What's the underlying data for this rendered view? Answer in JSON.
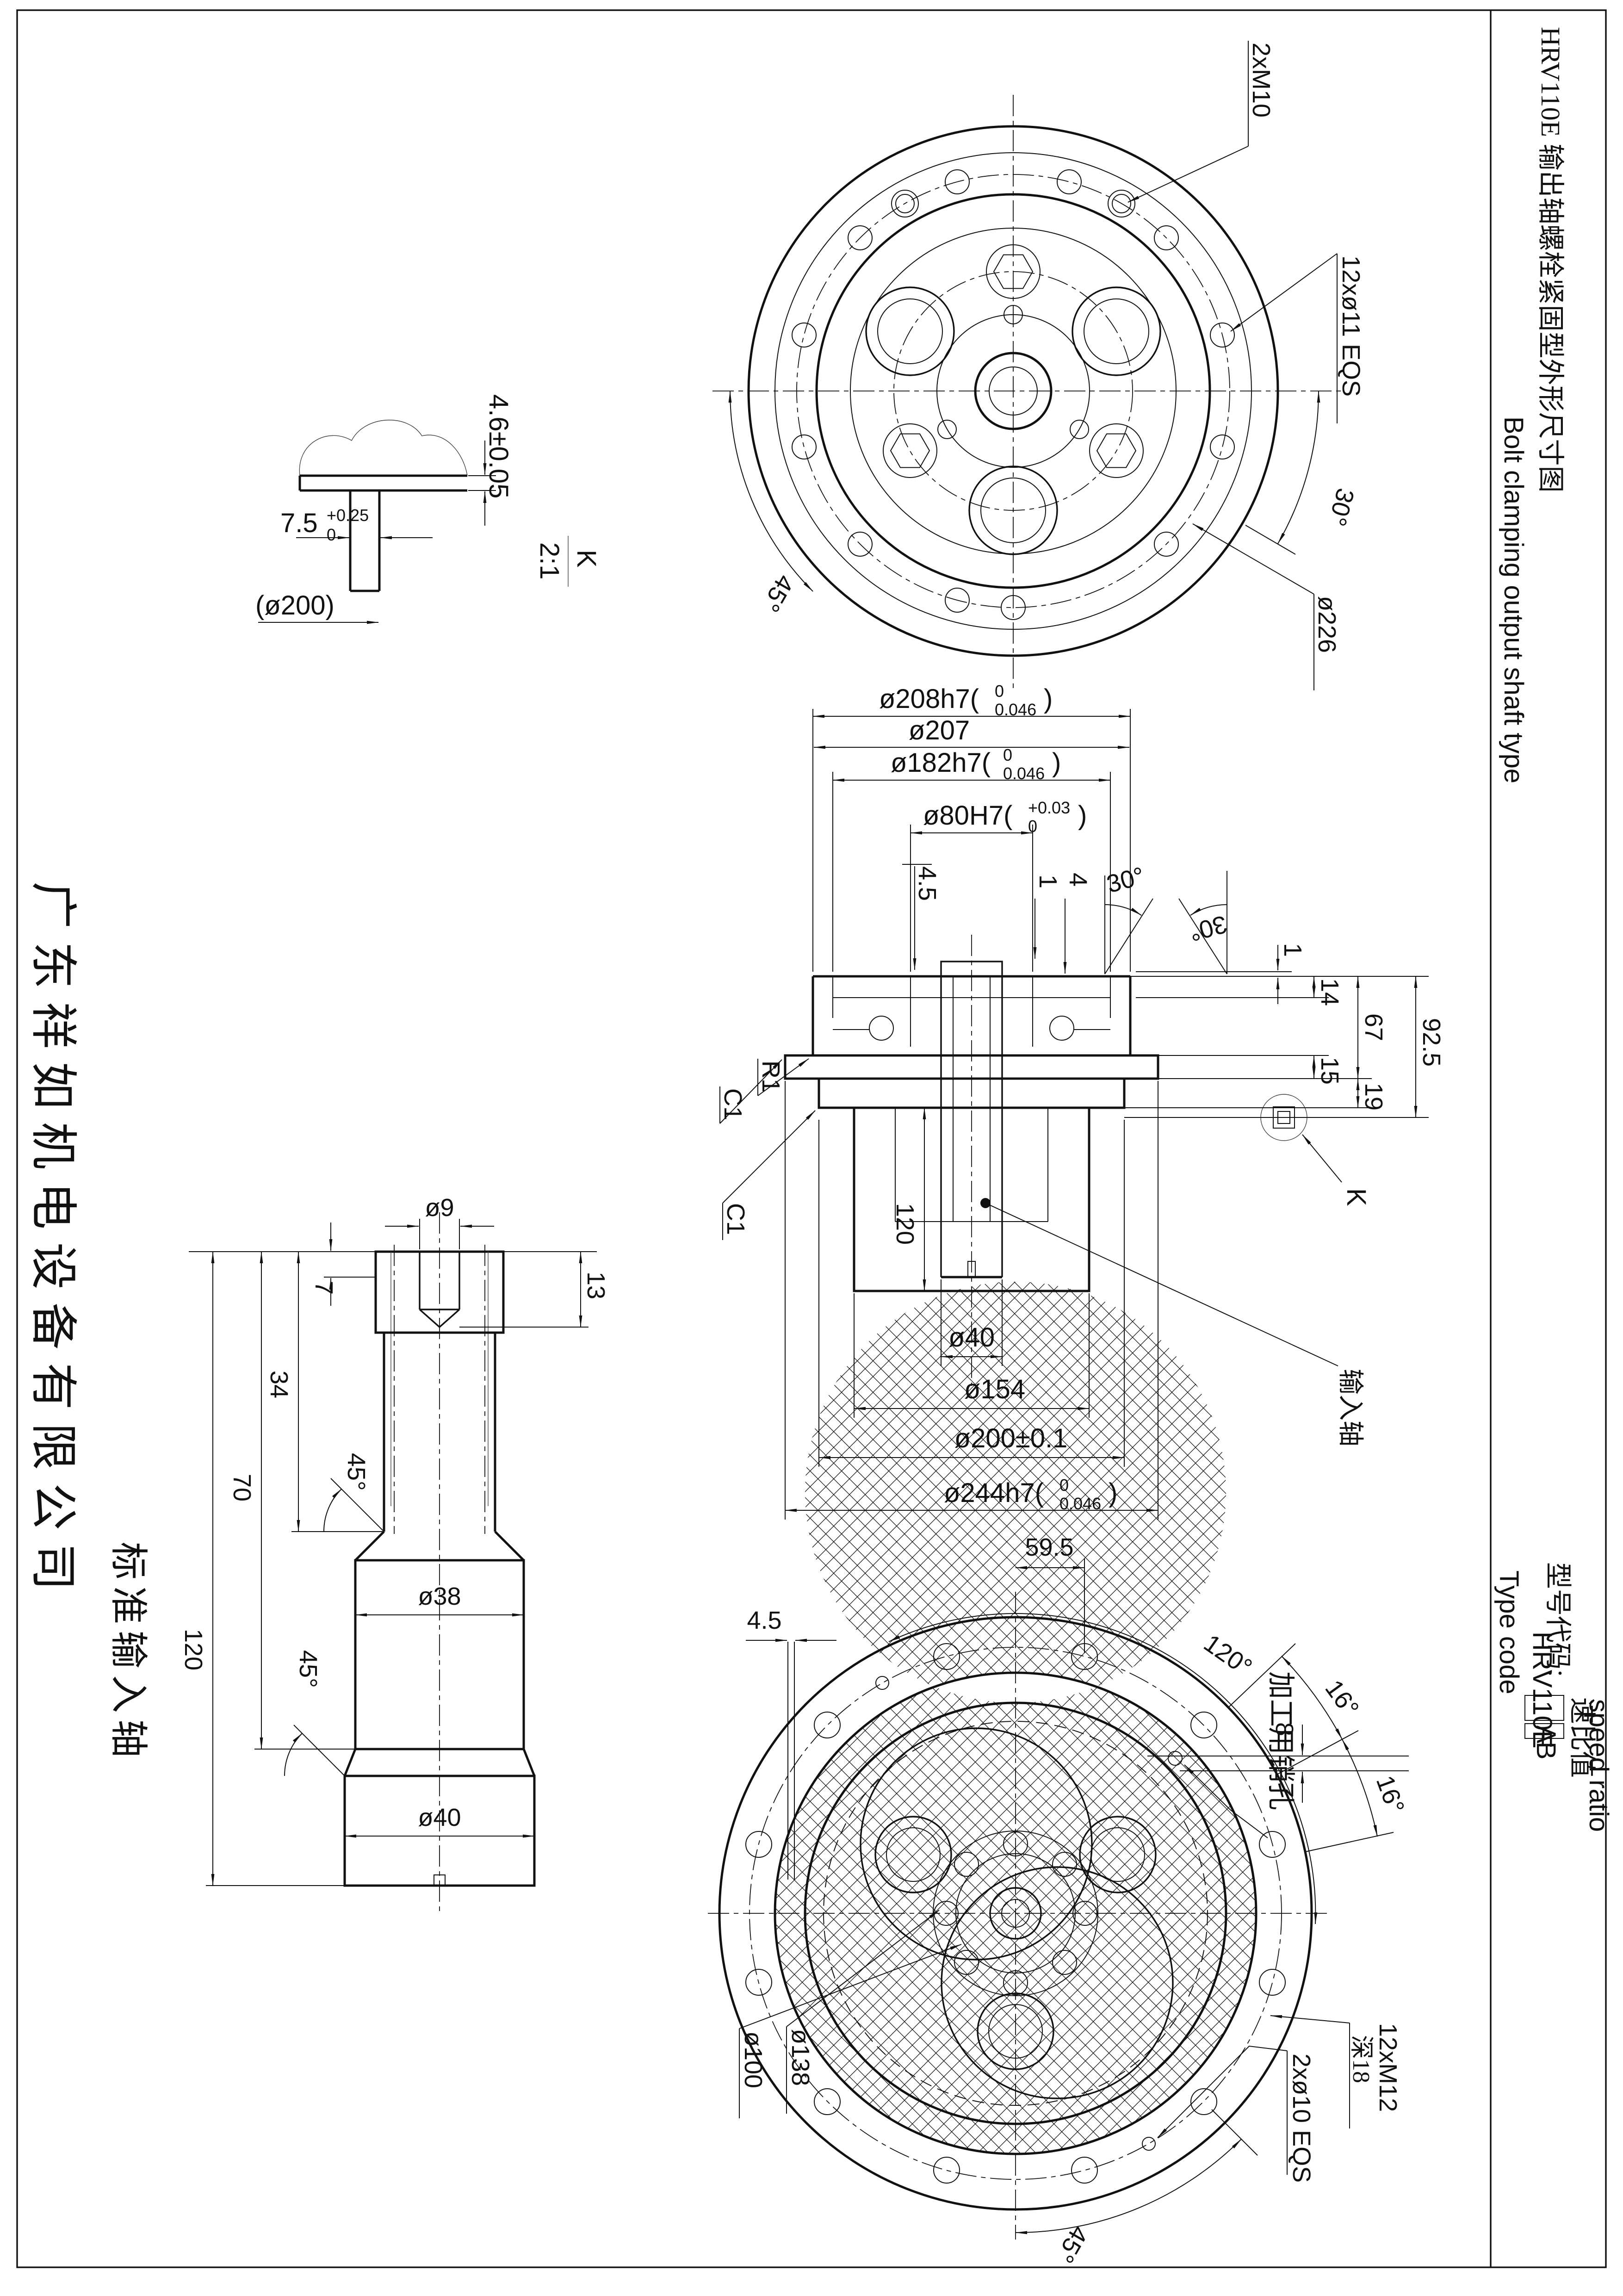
{
  "titleblock": {
    "title": "HRV110E 输出轴螺栓紧固型外形尺寸图",
    "subtitle": "Bolt clamping output shaft type",
    "type_label_cn": "型号代码:",
    "type_label_en": "Type code",
    "model": "HRV110E",
    "ratio_cn": "速比值",
    "ratio_en": "speed ratio",
    "opt_a": "A",
    "opt_b": "B"
  },
  "margin": {
    "company": "广东祥如机电设备有限公司",
    "shaft_caption": "标准输入轴"
  },
  "common": {
    "paren": ")",
    "deg30": "30°",
    "deg45": "45°",
    "deg16": "16°",
    "c1": "C1"
  },
  "top_view": {
    "pins": "2xM10",
    "bolts": "12xø11 EQS",
    "bcd": "ø226"
  },
  "detail_k": {
    "label": "K",
    "scale": "2:1",
    "thickness": "4.6±0.05",
    "width": "7.5",
    "tol_up": "+0.25",
    "tol_dn": "0",
    "ref": "(ø200)"
  },
  "section": {
    "d208": "ø208h7(",
    "d207": "ø207",
    "d182": "ø182h7(",
    "d80": "ø80H7(",
    "h7_up": "0",
    "h7_dn": "0.046",
    "h80_up": "+0.03",
    "h80_dn": "0",
    "dim45": "4.5",
    "dim4": "4",
    "dim1": "1",
    "dim14": "14",
    "dim67": "67",
    "dim925": "92.5",
    "dim15": "15",
    "dim19": "19",
    "r1": "R1",
    "dim120": "120",
    "d40": "ø40",
    "d154": "ø154",
    "d200": "ø200±0.1",
    "d244": "ø244h7(",
    "input_shaft": "输入轴",
    "k": "K"
  },
  "shaft": {
    "d9": "ø9",
    "dim7": "7",
    "dim13": "13",
    "dim34": "34",
    "dim70": "70",
    "dim120": "120",
    "d38": "ø38",
    "d40": "ø40"
  },
  "bottom_view": {
    "dim595": "59.5",
    "dim45": "4.5",
    "deg120": "120°",
    "pin_label": "加工用销孔",
    "dim8": "8",
    "m12": "12xM12",
    "m12_depth": "深18",
    "pins": "2xø10 EQS",
    "d138": "ø138",
    "d100": "ø100"
  }
}
